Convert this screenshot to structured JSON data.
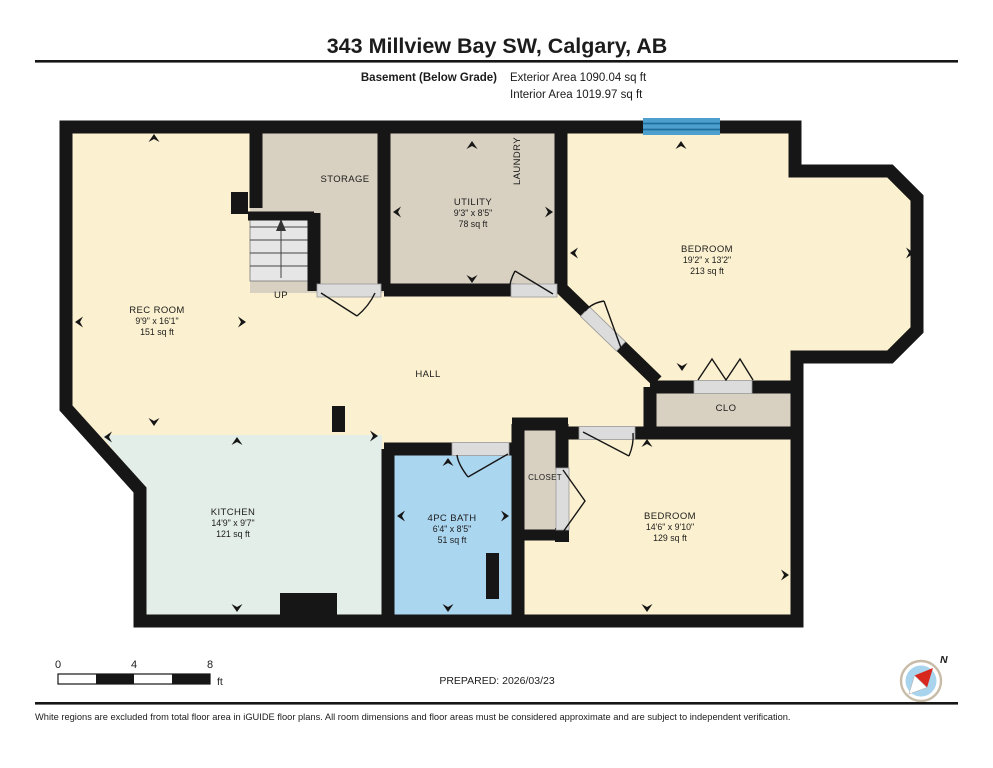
{
  "header": {
    "title": "343 Millview Bay SW, Calgary, AB",
    "floor_label": "Basement (Below Grade)",
    "exterior_area": "Exterior Area 1090.04 sq ft",
    "interior_area": "Interior Area 1019.97 sq ft"
  },
  "rooms": {
    "rec_room": {
      "name": "REC ROOM",
      "dims": "9'9\" x 16'1\"",
      "area": "151 sq ft"
    },
    "storage": {
      "name": "STORAGE"
    },
    "utility": {
      "name": "UTILITY",
      "dims": "9'3\" x 8'5\"",
      "area": "78 sq ft"
    },
    "laundry": {
      "name": "LAUNDRY"
    },
    "bedroom_top": {
      "name": "BEDROOM",
      "dims": "19'2\" x 13'2\"",
      "area": "213 sq ft"
    },
    "hall": {
      "name": "HALL"
    },
    "clo": {
      "name": "CLO"
    },
    "closet": {
      "name": "CLOSET"
    },
    "kitchen": {
      "name": "KITCHEN",
      "dims": "14'9\" x 9'7\"",
      "area": "121 sq ft"
    },
    "bath": {
      "name": "4PC BATH",
      "dims": "6'4\" x 8'5\"",
      "area": "51 sq ft"
    },
    "bedroom_bottom": {
      "name": "BEDROOM",
      "dims": "14'6\" x 9'10\"",
      "area": "129 sq ft"
    },
    "stairs": {
      "label": "UP"
    }
  },
  "footer": {
    "scale": {
      "start": "0",
      "mid": "4",
      "end": "8",
      "unit": "ft"
    },
    "prepared": "PREPARED: 2026/03/23",
    "compass_label": "N",
    "disclaimer": "White regions are excluded from total floor area in iGUIDE floor plans. All room dimensions and floor areas must be considered approximate and are subject to independent verification."
  },
  "colors": {
    "room_cream": "#FBF0CF",
    "room_tan": "#D8D0C1",
    "room_mint": "#E4EEE8",
    "room_blue": "#ABD6F0",
    "window_blue": "#4D9FCE",
    "wall_black": "#161616",
    "compass_fill": "#A9D4EE",
    "compass_needle_red": "#D8281E"
  }
}
